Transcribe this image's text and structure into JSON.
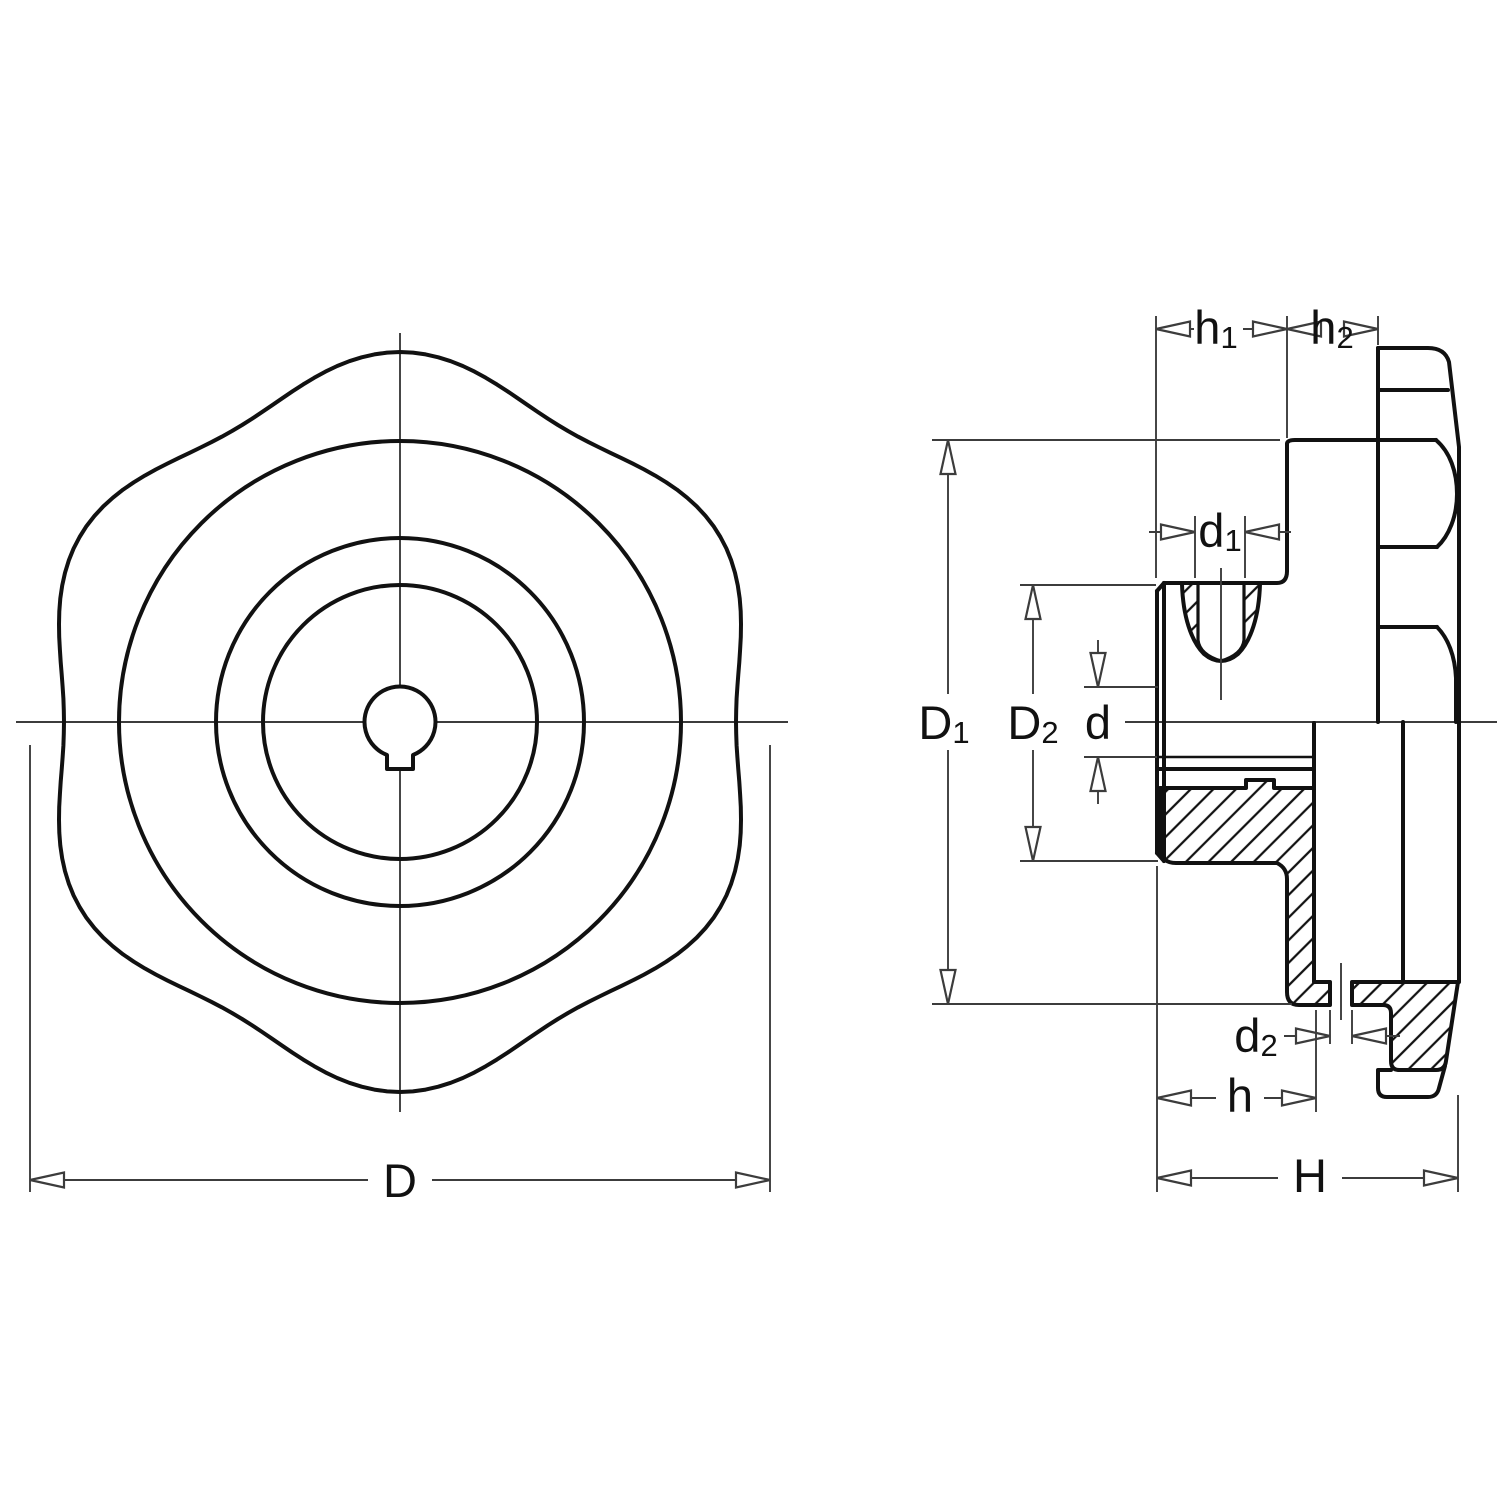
{
  "drawing": {
    "type": "technical-drawing",
    "part": "six-lobed hand knob with keyed bore, front view and half-sectioned side view"
  },
  "colors": {
    "line": "#111111",
    "thin_line": "#3c3c3c",
    "background": "#ffffff"
  },
  "labels": {
    "D": {
      "base": "D",
      "sub": ""
    },
    "D1": {
      "base": "D",
      "sub": "1"
    },
    "D2": {
      "base": "D",
      "sub": "2"
    },
    "d": {
      "base": "d",
      "sub": ""
    },
    "d1": {
      "base": "d",
      "sub": "1"
    },
    "d2": {
      "base": "d",
      "sub": "2"
    },
    "h": {
      "base": "h",
      "sub": ""
    },
    "h1": {
      "base": "h",
      "sub": "1"
    },
    "h2": {
      "base": "h",
      "sub": "2"
    },
    "H": {
      "base": "H",
      "sub": ""
    }
  }
}
